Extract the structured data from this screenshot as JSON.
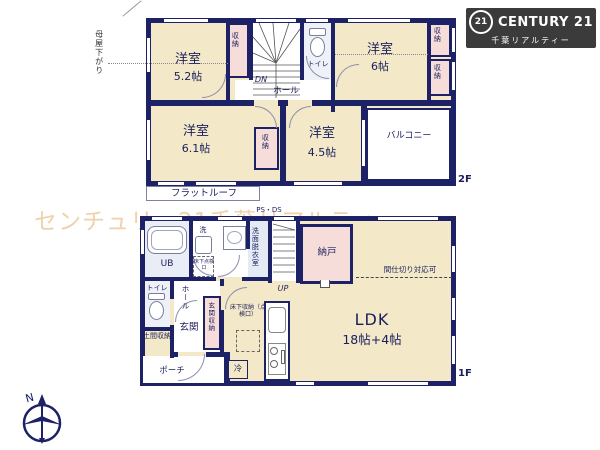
{
  "brand": {
    "logo_number": "21",
    "logo_text": "CENTURY 21",
    "logo_subtitle": "千葉リアルティー"
  },
  "watermark": "センチュリー21千葉リアルティー",
  "compass_north": "N",
  "f2": {
    "tag": "2F",
    "room52_name": "洋室",
    "room52_size": "5.2帖",
    "room6_name": "洋室",
    "room6_size": "6帖",
    "room61_name": "洋室",
    "room61_size": "6.1帖",
    "room45_name": "洋室",
    "room45_size": "4.5帖",
    "balcony": "バルコニー",
    "flat_roof": "フラットルーフ",
    "hall": "ホール",
    "toilet": "トイレ",
    "dn": "DN",
    "closet": "収納",
    "eaves": "母屋下がり"
  },
  "f1": {
    "tag": "1F",
    "ldk_name": "LDK",
    "ldk_size": "18帖+4帖",
    "storeroom": "納戸",
    "partition": "間仕切り対応可",
    "ub": "UB",
    "laundry": "洗",
    "washroom": "洗面脱衣室",
    "ps": "PS・DS",
    "up": "UP",
    "toilet": "トイレ",
    "hall": "ホール",
    "entrance": "玄関",
    "entrance_storage": "玄関収納",
    "doma_storage": "土間収納",
    "porch": "ポーチ",
    "fridge": "冷",
    "underfloor_hatch": "床下点検口",
    "underfloor_storage": "床下収納（点検口）"
  }
}
